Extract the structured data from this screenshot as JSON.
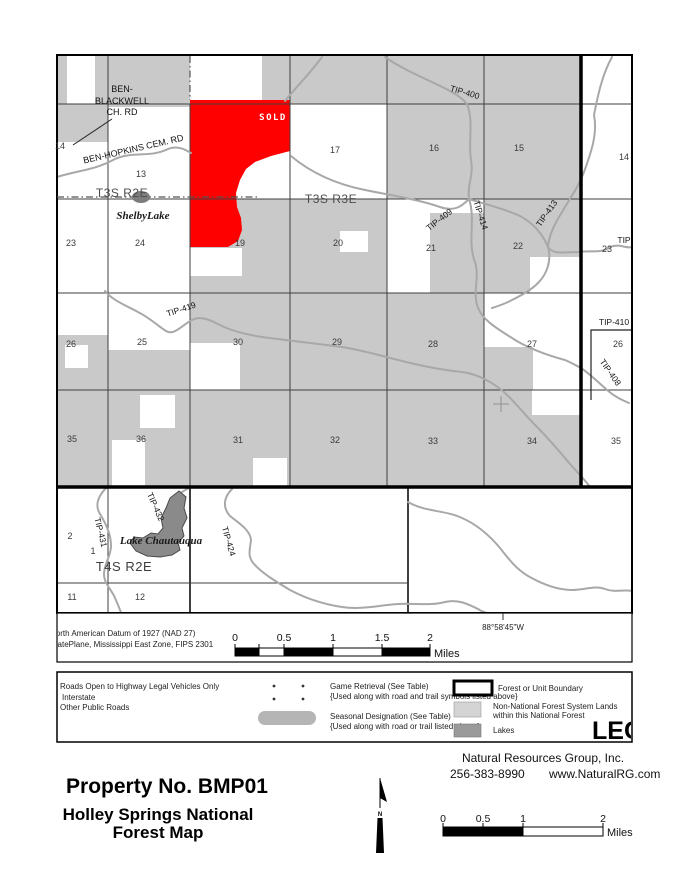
{
  "map": {
    "sold_label": "SOLD",
    "coordinate_label": "88°58'45\"W",
    "townships": {
      "t3s_r2e": "T3S R2E",
      "t3s_r3e": "T3S R3E",
      "t4s_r2e": "T4S R2E"
    },
    "places": {
      "ben_blackwell_1": "BEN-",
      "ben_blackwell_2": "BLACKWELL",
      "ben_blackwell_3": "CH. RD",
      "ben_hopkins": "BEN-HOPKINS CEM. RD",
      "shelby_lake": "ShelbyLake",
      "lake_chautauqua": "Lake Chautauqua"
    },
    "roads": [
      "TIP-400",
      "TIP-409",
      "TIP-414",
      "TIP-413",
      "TIP",
      "TIP-419",
      "TIP-410",
      "TIP-408",
      "TIP-431",
      "TIP-432",
      "TIP-424"
    ],
    "sections": [
      "14",
      "13",
      "17",
      "16",
      "15",
      "14",
      "23",
      "24",
      "19",
      "20",
      "21",
      "22",
      "23",
      "26",
      "25",
      "30",
      "29",
      "28",
      "27",
      "26",
      "35",
      "36",
      "31",
      "32",
      "33",
      "34",
      "35",
      "2",
      "1",
      "11",
      "12"
    ]
  },
  "collar": {
    "datum_line1": "North American Datum of 1927 (NAD 27)",
    "datum_line2": "StatePlane, Mississippi East Zone, FIPS 2301",
    "scale": {
      "ticks": [
        "0",
        "0.5",
        "1",
        "1.5",
        "2"
      ],
      "unit": "Miles"
    }
  },
  "legend": {
    "title": "LEGEND",
    "left_items": [
      "Roads Open to Highway Legal Vehicles Only",
      "Interstate",
      "Other Public Roads"
    ],
    "game_retrieval_1": "Game Retrieval (See Table)",
    "game_retrieval_2": "{Used along with road and trail symbols listed above}",
    "seasonal_1": "Seasonal Designation (See Table)",
    "seasonal_2": "{Used along with road or trail listed above}",
    "boundary_label": "Forest or Unit Boundary",
    "nonforest_label_1": "Non-National Forest System Lands",
    "nonforest_label_2": "within this National Forest",
    "lakes_label": "Lakes"
  },
  "footer": {
    "company": "Natural Resources Group, Inc.",
    "phone": "256-383-8990",
    "website": "www.NaturalRG.com",
    "property_title": "Property No. BMP01",
    "map_title_1": "Holley Springs National",
    "map_title_2": "Forest Map",
    "north_label": "N",
    "scale": {
      "ticks": [
        "0",
        "0.5",
        "1",
        "2"
      ],
      "unit": "Miles"
    }
  },
  "colors": {
    "sold_red": "#ff0000",
    "nonforest_gray": "#c9c9c9",
    "lake_gray": "#8a8a8a",
    "road_gray": "#a8a8a8",
    "boundary_black": "#000000"
  }
}
